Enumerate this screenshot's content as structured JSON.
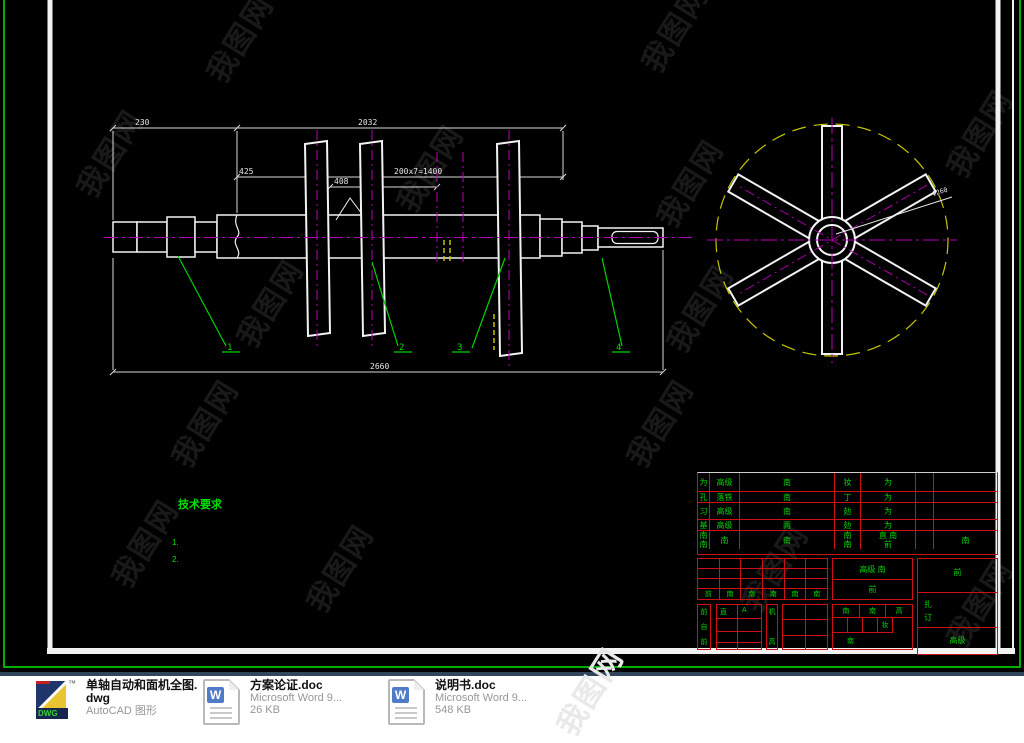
{
  "watermark": {
    "text": "我图网",
    "dark_color": "#191919",
    "light_color": "#e9e9e9"
  },
  "drawing": {
    "dims": {
      "top_left": "230",
      "top_right": "2032",
      "seg": "425",
      "pitch": "200x7=1400",
      "blade_gap": "408",
      "overall_bottom": "2660",
      "shaft_dia_left": "Φ100",
      "shaft_dia_right": "Φ140",
      "circle_dia": "Φ260"
    },
    "callouts": [
      "1",
      "2",
      "3",
      "4"
    ],
    "tech_req": {
      "title": "技术要求",
      "item1": "1.",
      "item2": "2."
    }
  },
  "titleblock": {
    "upper": {
      "r1": [
        "为",
        "高级",
        "南",
        "妆",
        "为",
        "",
        ""
      ],
      "r2": [
        "孔",
        "落铁",
        "南",
        "丁",
        "为",
        "",
        ""
      ],
      "r3": [
        "习",
        "高级",
        "南",
        "攰",
        "为",
        "",
        ""
      ],
      "r4": [
        "基",
        "高级",
        "两",
        "攰",
        "为",
        "",
        ""
      ],
      "r5": [
        "南\n南",
        "南",
        "南",
        "南\n南",
        "直 南\n前",
        "",
        "南"
      ]
    },
    "lower_left_footer": [
      "前",
      "南",
      "南",
      "南",
      "南",
      "南"
    ],
    "box_a": [
      "前",
      "自",
      "前"
    ],
    "box_b": {
      "c1": "直",
      "c2": "A"
    },
    "box_c": {
      "top": "机",
      "bottom": "高"
    },
    "mid_top": {
      "line1": "高级   南",
      "line2": "前"
    },
    "mid_bottom": {
      "h1": "南",
      "h2": "南",
      "h3": "高",
      "cell": "妆",
      "foot": "南"
    },
    "right": {
      "top": "前",
      "l1": "扎",
      "l2": "订",
      "bottom": "高级"
    }
  },
  "files": [
    {
      "icon_label": "DWG",
      "trademark": "™",
      "name_line1": "单轴自动和面机全图.",
      "name_line2": "dwg",
      "meta": "AutoCAD 图形"
    },
    {
      "icon_letter": "W",
      "name": "方案论证.doc",
      "meta": "Microsoft Word 9...",
      "size": "26 KB"
    },
    {
      "icon_letter": "W",
      "name": "说明书.doc",
      "meta": "Microsoft Word 9...",
      "size": "548 KB"
    }
  ],
  "colors": {
    "cad_white": "#f2f2f2",
    "cad_green": "#00d400",
    "magenta": "#b800b8",
    "yellow": "#c6c600",
    "grid_red": "#cf1010",
    "border_green": "#00b000",
    "divider_blue": "#31455c",
    "word_blue": "#4f7bc7",
    "dwg_navy": "#20356b",
    "dwg_yellow": "#e8c430"
  }
}
